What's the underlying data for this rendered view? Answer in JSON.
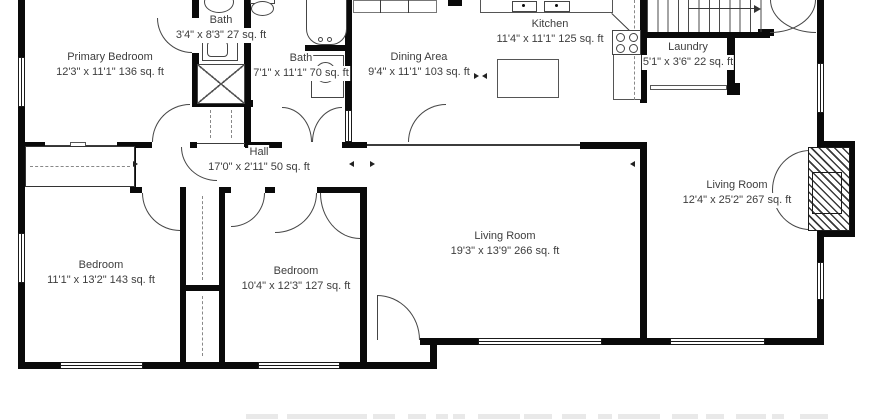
{
  "plan": {
    "rooms": [
      {
        "slug": "primary-bedroom",
        "name": "Primary Bedroom",
        "dims": "12'3\" x 11'1\" 136 sq. ft",
        "cx": 110,
        "cy": 50
      },
      {
        "slug": "bath-1",
        "name": "Bath",
        "dims": "3'4\" x 8'3\" 27 sq. ft",
        "cx": 221,
        "cy": 13
      },
      {
        "slug": "bath-2",
        "name": "Bath",
        "dims": "7'1\" x 11'1\" 70 sq. ft",
        "cx": 301,
        "cy": 51
      },
      {
        "slug": "dining-area",
        "name": "Dining Area",
        "dims": "9'4\" x 11'1\" 103 sq. ft",
        "cx": 419,
        "cy": 50
      },
      {
        "slug": "kitchen",
        "name": "Kitchen",
        "dims": "11'4\" x 11'1\" 125 sq. ft",
        "cx": 550,
        "cy": 17
      },
      {
        "slug": "laundry",
        "name": "Laundry",
        "dims": "5'1\" x 3'6\" 22 sq. ft",
        "cx": 688,
        "cy": 40
      },
      {
        "slug": "hall",
        "name": "Hall",
        "dims": "17'0\" x 2'11\" 50 sq. ft",
        "cx": 259,
        "cy": 145
      },
      {
        "slug": "living-room-right",
        "name": "Living Room",
        "dims": "12'4\" x 25'2\" 267 sq. ft",
        "cx": 737,
        "cy": 178
      },
      {
        "slug": "living-room-main",
        "name": "Living Room",
        "dims": "19'3\" x 13'9\" 266 sq. ft",
        "cx": 505,
        "cy": 229
      },
      {
        "slug": "bedroom-1",
        "name": "Bedroom",
        "dims": "11'1\" x 13'2\" 143 sq. ft",
        "cx": 101,
        "cy": 258
      },
      {
        "slug": "bedroom-2",
        "name": "Bedroom",
        "dims": "10'4\" x 12'3\" 127 sq. ft",
        "cx": 296,
        "cy": 264
      }
    ]
  }
}
